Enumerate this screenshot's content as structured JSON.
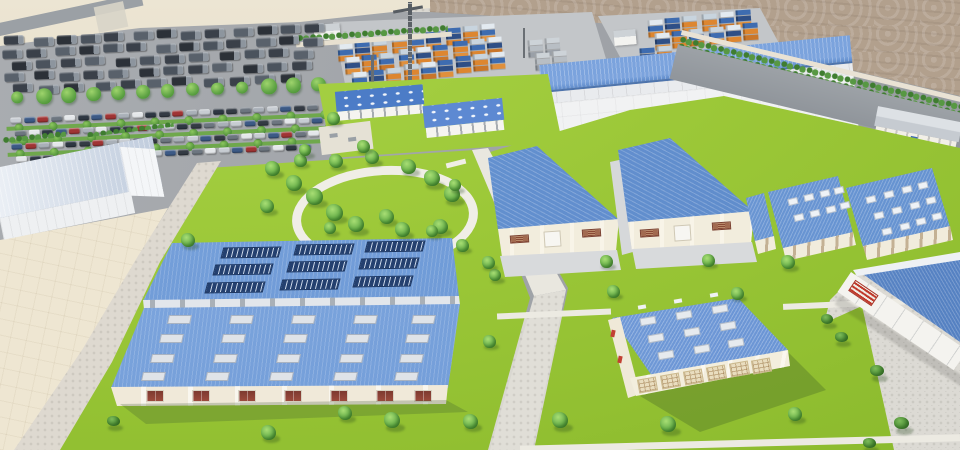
{
  "scene": {
    "type": "3d-architectural-rendering",
    "subject": "industrial logistics park masterplan with warehouses, container yards, parking lots and landscaped grounds",
    "visible_text": []
  },
  "colors": {
    "sand": "#e7dfcc",
    "dirt": "#b3a190",
    "asphalt": "#a2a6aa",
    "concrete_pad": "#c3c6c9",
    "paver": "#dbd9d3",
    "beige_yard": "#eee6d2",
    "lawn": "#9cc838",
    "roof_blue": "#6f9ad6",
    "roof_blue_dark": "#5e88c8",
    "solar_navy": "#24406f",
    "wall_cream": "#f2ecdc",
    "wall_white": "#f1f2f3",
    "container_orange": "#dd8630",
    "container_blue": "#3e6cb0",
    "container_white": "#e3eaf0",
    "tree_green": "#68b04a",
    "hedge_green": "#4e8f3c",
    "ring_path_white": "#f0eee6",
    "window_red": "#8a3e34",
    "grille_red": "#c0392b"
  },
  "objects": {
    "trees": [
      [
        272,
        168,
        15
      ],
      [
        294,
        183,
        16
      ],
      [
        314,
        196,
        17
      ],
      [
        267,
        206,
        14
      ],
      [
        334,
        212,
        17
      ],
      [
        356,
        224,
        16
      ],
      [
        386,
        216,
        15
      ],
      [
        402,
        229,
        15
      ],
      [
        336,
        161,
        14
      ],
      [
        372,
        157,
        14
      ],
      [
        408,
        166,
        15
      ],
      [
        432,
        178,
        16
      ],
      [
        452,
        194,
        16
      ],
      [
        440,
        226,
        15
      ],
      [
        300,
        160,
        13
      ],
      [
        333,
        118,
        13
      ],
      [
        363,
        146,
        13
      ],
      [
        305,
        150,
        12
      ],
      [
        188,
        240,
        14
      ],
      [
        330,
        228,
        12
      ],
      [
        432,
        231,
        12
      ],
      [
        455,
        185,
        12
      ],
      [
        462,
        245,
        13
      ],
      [
        495,
        275,
        12
      ],
      [
        489,
        341,
        13
      ],
      [
        392,
        420,
        16
      ],
      [
        470,
        421,
        15
      ],
      [
        268,
        432,
        15
      ],
      [
        345,
        413,
        14
      ],
      [
        488,
        262,
        13
      ],
      [
        606,
        261,
        13
      ],
      [
        708,
        260,
        13
      ],
      [
        788,
        262,
        14
      ],
      [
        613,
        291,
        13
      ],
      [
        737,
        293,
        13
      ],
      [
        560,
        420,
        16
      ],
      [
        668,
        424,
        16
      ],
      [
        795,
        414,
        14
      ]
    ],
    "bushes": [
      [
        827,
        320,
        12
      ],
      [
        841,
        338,
        13
      ],
      [
        877,
        372,
        14
      ],
      [
        901,
        424,
        15
      ],
      [
        869,
        444,
        13
      ],
      [
        113,
        422,
        13
      ]
    ],
    "solar_arrays": [
      [
        222,
        247
      ],
      [
        295,
        244
      ],
      [
        366,
        241
      ],
      [
        214,
        264
      ],
      [
        288,
        261
      ],
      [
        360,
        258
      ],
      [
        206,
        282
      ],
      [
        281,
        279
      ],
      [
        354,
        276
      ]
    ],
    "factory_skylights": [
      [
        168,
        315
      ],
      [
        230,
        315
      ],
      [
        292,
        315
      ],
      [
        354,
        315
      ],
      [
        412,
        315
      ],
      [
        160,
        334
      ],
      [
        222,
        334
      ],
      [
        284,
        334
      ],
      [
        346,
        334
      ],
      [
        406,
        334
      ],
      [
        151,
        354
      ],
      [
        214,
        354
      ],
      [
        277,
        354
      ],
      [
        340,
        354
      ],
      [
        400,
        354
      ],
      [
        142,
        372
      ],
      [
        206,
        372
      ],
      [
        270,
        372
      ],
      [
        334,
        372
      ],
      [
        395,
        372
      ]
    ],
    "factory_windows": [
      146,
      192,
      238,
      284,
      330,
      376,
      414
    ],
    "medium_skylights": [
      [
        640,
        317
      ],
      [
        676,
        311
      ],
      [
        712,
        305
      ],
      [
        648,
        334
      ],
      [
        684,
        328
      ],
      [
        720,
        322
      ],
      [
        658,
        351
      ],
      [
        694,
        345
      ],
      [
        728,
        339
      ]
    ],
    "medium_vents": [
      [
        638,
        305
      ],
      [
        674,
        299
      ],
      [
        710,
        293
      ]
    ],
    "medium_doors": [
      [
        638,
        378
      ],
      [
        661,
        374
      ],
      [
        684,
        370
      ],
      [
        707,
        366
      ],
      [
        730,
        362
      ],
      [
        752,
        359
      ]
    ],
    "b2_dots": [
      [
        788,
        198
      ],
      [
        804,
        194
      ],
      [
        820,
        190
      ],
      [
        834,
        187
      ],
      [
        794,
        214
      ],
      [
        810,
        210
      ],
      [
        826,
        206
      ],
      [
        840,
        202
      ]
    ],
    "b3_dots": [
      [
        866,
        196
      ],
      [
        884,
        191
      ],
      [
        902,
        186
      ],
      [
        918,
        182
      ],
      [
        874,
        212
      ],
      [
        892,
        207
      ],
      [
        910,
        202
      ],
      [
        926,
        197
      ],
      [
        882,
        228
      ],
      [
        900,
        223
      ],
      [
        916,
        218
      ],
      [
        932,
        213
      ]
    ],
    "container_clusters": [
      {
        "x": 338,
        "y": 44,
        "cols": 3,
        "rows": 2
      },
      {
        "x": 392,
        "y": 36,
        "cols": 3,
        "rows": 2
      },
      {
        "x": 446,
        "y": 28,
        "cols": 3,
        "rows": 2
      },
      {
        "x": 352,
        "y": 72,
        "cols": 3,
        "rows": 1
      },
      {
        "x": 404,
        "y": 64,
        "cols": 3,
        "rows": 1
      },
      {
        "x": 456,
        "y": 56,
        "cols": 3,
        "rows": 1
      },
      {
        "x": 648,
        "y": 20,
        "cols": 3,
        "rows": 2
      },
      {
        "x": 702,
        "y": 14,
        "cols": 3,
        "rows": 2
      },
      {
        "x": 640,
        "y": 48,
        "cols": 2,
        "rows": 1
      },
      {
        "x": 528,
        "y": 40,
        "cols": 2,
        "rows": 2,
        "gray": true
      }
    ],
    "lot": {
      "truck_rows": [
        {
          "y": 12,
          "x0": 4,
          "n": 13,
          "dx": 25
        },
        {
          "y": 24,
          "x0": 0,
          "n": 13,
          "dx": 25
        },
        {
          "y": 36,
          "x0": 6,
          "n": 12,
          "dx": 26
        },
        {
          "y": 48,
          "x0": 2,
          "n": 12,
          "dx": 26
        },
        {
          "y": 60,
          "x0": 8,
          "n": 11,
          "dx": 27
        }
      ],
      "tree_row": {
        "y": 74,
        "x0": 6,
        "n": 13,
        "dx": 25
      },
      "car_rows": [
        {
          "y": 94,
          "x0": 4,
          "n": 23,
          "dx": 13.5
        },
        {
          "y": 107,
          "x0": 8,
          "n": 23,
          "dx": 13.5
        },
        {
          "y": 120,
          "x0": 4,
          "n": 23,
          "dx": 13.5
        },
        {
          "y": 133,
          "x0": 8,
          "n": 22,
          "dx": 13.5
        }
      ],
      "hedge_rows": [
        {
          "y": 103,
          "x0": 0,
          "w": 322
        },
        {
          "y": 116,
          "x0": 4,
          "w": 318
        },
        {
          "y": 129,
          "x0": 0,
          "w": 322
        }
      ],
      "side_trees": [
        [
          326,
          86
        ],
        [
          332,
          100
        ],
        [
          338,
          114
        ],
        [
          344,
          128
        ]
      ]
    },
    "palettes": {
      "car": [
        "#c7ccd2",
        "#343b44",
        "#a9b0b8",
        "#2e3742",
        "#a03434",
        "#e4e7ea",
        "#3c5a86",
        "#6d7680"
      ],
      "truck": [
        "#3a4049",
        "#4b535d",
        "#2c3138",
        "#59616b"
      ],
      "container_bottom": [
        "#dd8630",
        "#c9762a",
        "#e0903c"
      ],
      "container_mid": [
        "#3e6cb0",
        "#2f4f86",
        "#dd8630"
      ],
      "container_top": [
        "#e3eaf0",
        "#c8d4de",
        "#3e6cb0"
      ],
      "container_gray": [
        "#9aa0a8",
        "#b8bec4",
        "#cdd3d8"
      ]
    }
  }
}
